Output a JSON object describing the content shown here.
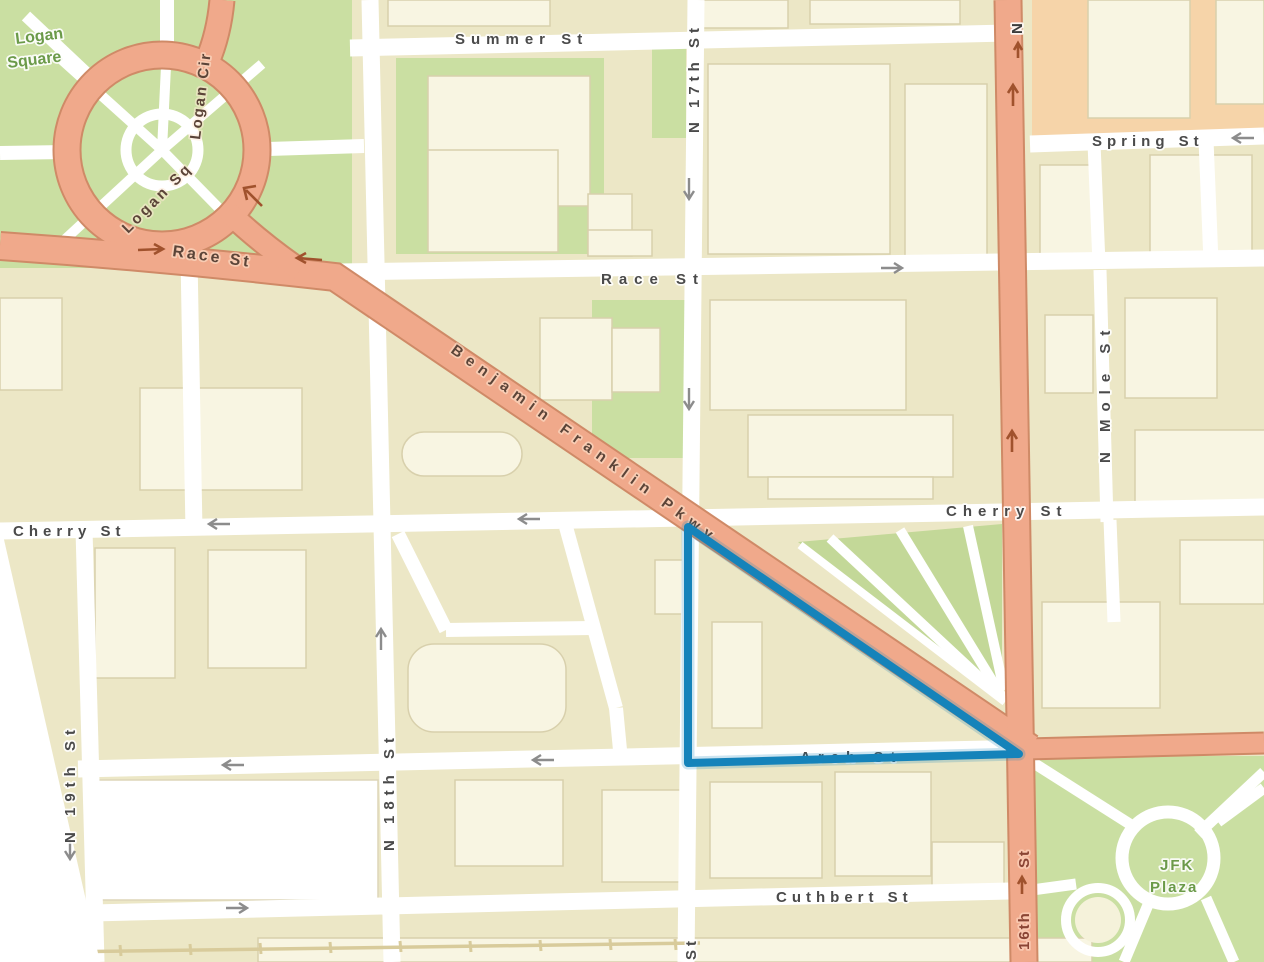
{
  "map": {
    "view": "street-map-with-selection",
    "place_labels": {
      "logan_square_line1": "Logan",
      "logan_square_line2": "Square",
      "jfk_line1": "JFK",
      "jfk_line2": "Plaza"
    },
    "street_labels": {
      "summer": "Summer St",
      "spring": "Spring St",
      "race": "Race St",
      "race_west": "Race St",
      "benjamin_franklin": "Benjamin Franklin Pkwy",
      "cherry_west": "Cherry St",
      "cherry_east": "Cherry St",
      "arch": "Arch St",
      "cuthbert": "Cuthbert St",
      "n17th": "N 17th St",
      "n18th": "N 18th St",
      "n19th": "N 19th St",
      "n_mole": "N Mole St",
      "sixteenth_part1": "16th",
      "sixteenth_part2": "St",
      "sixteenth_north_n": "N",
      "logan_sq": "Logan Sq",
      "logan_cir": "Logan Cir",
      "seventeenth_partial": "St"
    },
    "selection": {
      "shape": "triangle",
      "color": "#1583ba",
      "vertices_px": [
        [
          688,
          527
        ],
        [
          688,
          763
        ],
        [
          1019,
          754
        ]
      ]
    },
    "colors": {
      "block": "#ece7c6",
      "building": "#f8f5e2",
      "street": "#ffffff",
      "road_major": "#f0a98b",
      "road_major_border": "#cf8a67",
      "park": "#cadfa2",
      "district": "#f6d4a9",
      "rail": "#d8cb9b",
      "street_label": "#4a4a4a",
      "park_label": "#6b9a49",
      "road_label": "#5b4438",
      "highlight": "#1583ba"
    }
  }
}
